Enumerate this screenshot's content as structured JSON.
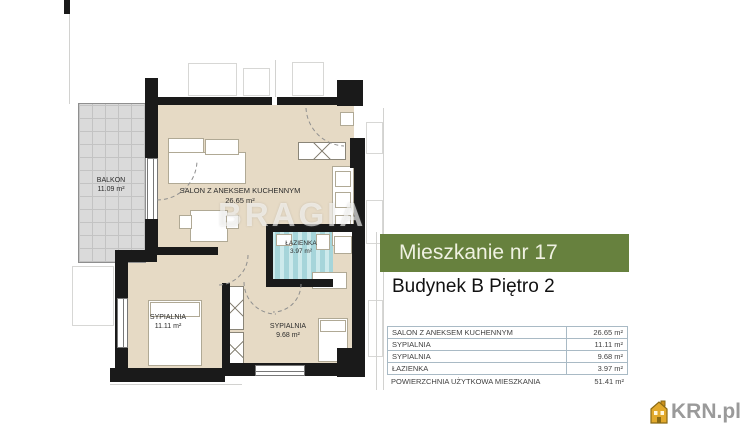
{
  "plan": {
    "rooms": [
      {
        "id": "balkon",
        "name": "BALKON",
        "area": "11.09 m²"
      },
      {
        "id": "salon",
        "name": "SALON Z ANEKSEM KUCHENNYM",
        "area": "26.65 m²"
      },
      {
        "id": "lazienka",
        "name": "ŁAZIENKA",
        "area": "3.97 m²"
      },
      {
        "id": "sypialnia1",
        "name": "SYPIALNIA",
        "area": "11.11 m²"
      },
      {
        "id": "sypialnia2",
        "name": "SYPIALNIA",
        "area": "9.68 m²"
      }
    ],
    "watermark": "BRAGIA"
  },
  "panel": {
    "title": "Mieszkanie nr 17",
    "subtitle": "Budynek B Piętro 2",
    "table": {
      "rows": [
        {
          "label": "SALON Z ANEKSEM KUCHENNYM",
          "value": "26.65 m²"
        },
        {
          "label": "SYPIALNIA",
          "value": "11.11 m²"
        },
        {
          "label": "SYPIALNIA",
          "value": "9.68 m²"
        },
        {
          "label": "ŁAZIENKA",
          "value": "3.97 m²"
        }
      ],
      "total": {
        "label": "POWIERZCHNIA UŻYTKOWA MIESZKANIA",
        "value": "51.41 m²"
      }
    }
  },
  "branding": {
    "logo_text": "KRN.pl"
  },
  "colors": {
    "header_green": "#67813e",
    "floor_beige": "#e6dac5",
    "bath_teal": "#a6d5da",
    "balcony_gray": "#dadada",
    "wall_black": "#1a1a1a",
    "logo_gold": "#e2a92c"
  }
}
